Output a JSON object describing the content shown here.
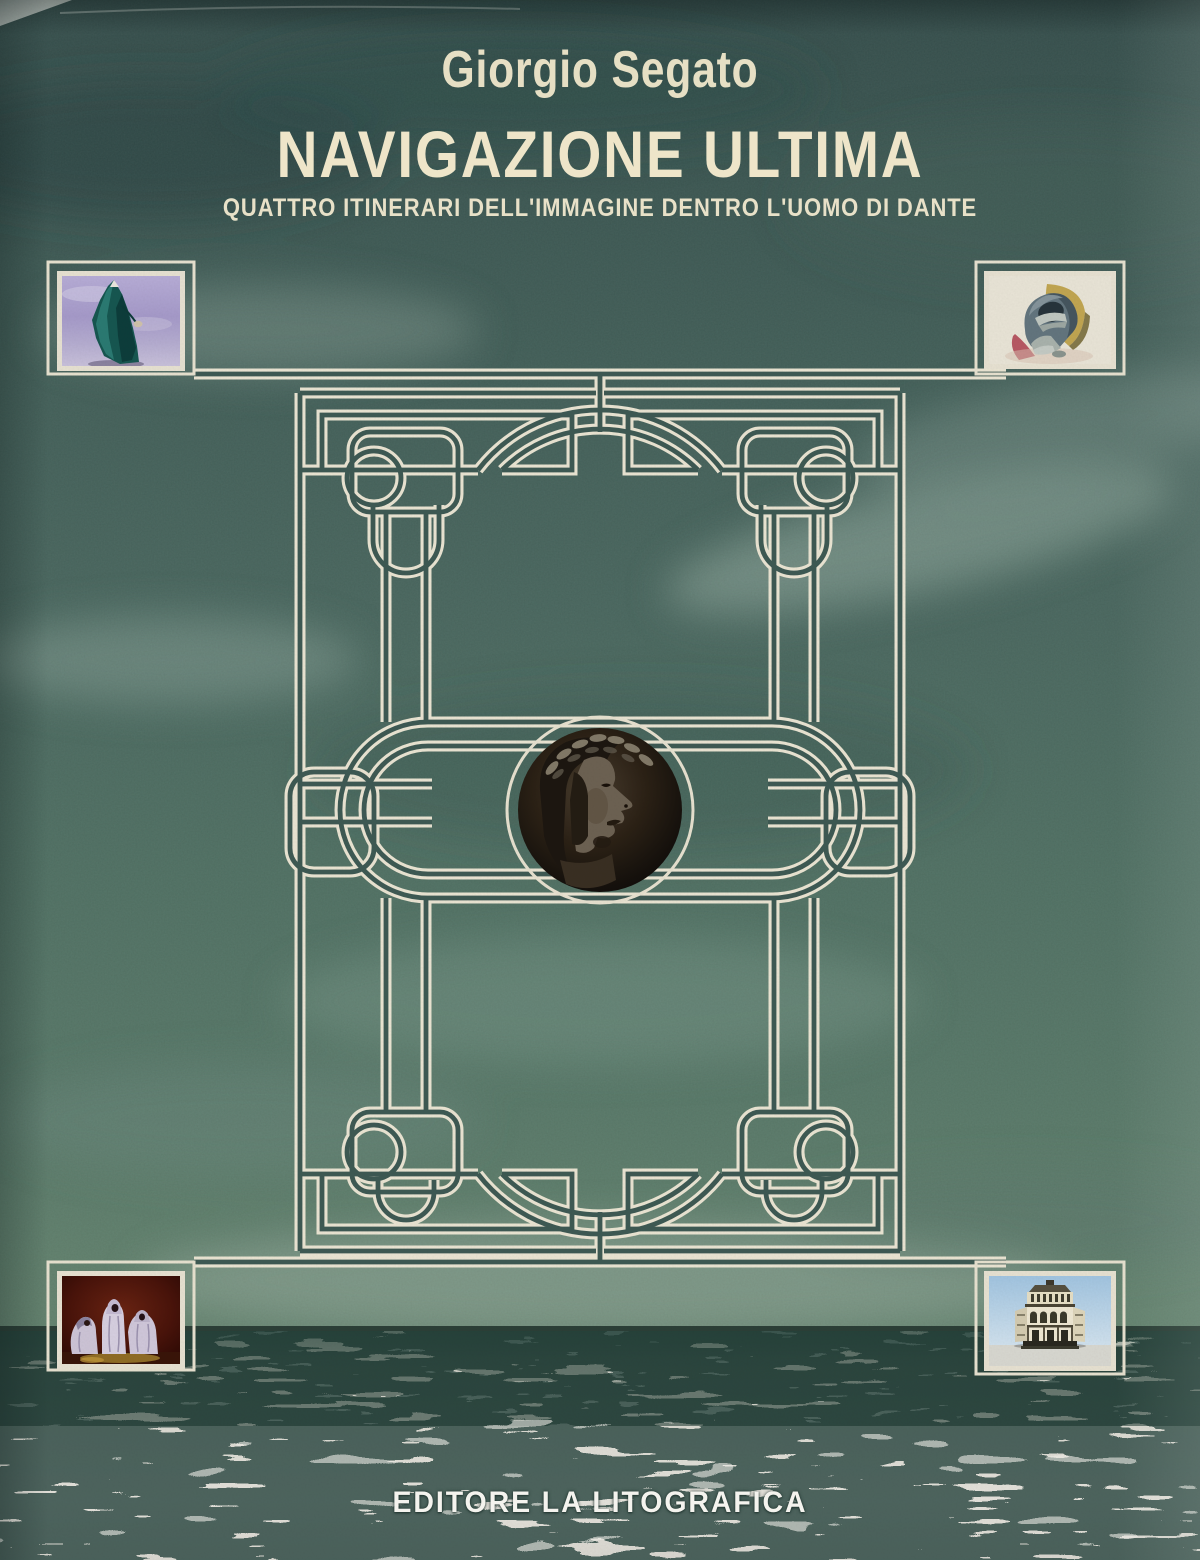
{
  "cover": {
    "author": "Giorgio Segato",
    "title": "NAVIGAZIONE ULTIMA",
    "subtitle": "QUATTRO ITINERARI DELL'IMMAGINE DENTRO L'UOMO DI DANTE",
    "publisher": "EDITORE LA LITOGRAFICA"
  },
  "artworks": {
    "top_left": "Cloaked figure against violet sky",
    "top_right": "Crouching nude figure",
    "bottom_left": "Three hooded robed figures",
    "bottom_right": "Florence Baptistery",
    "center_medallion": "Dante profile portrait with laurel wreath"
  },
  "colors": {
    "sky_teal": "#45635c",
    "ornament_cream": "#ece6d4",
    "title_cream": "#eee5c9",
    "sea_light": "#dedcd4",
    "horizon_dark": "#23362f"
  }
}
